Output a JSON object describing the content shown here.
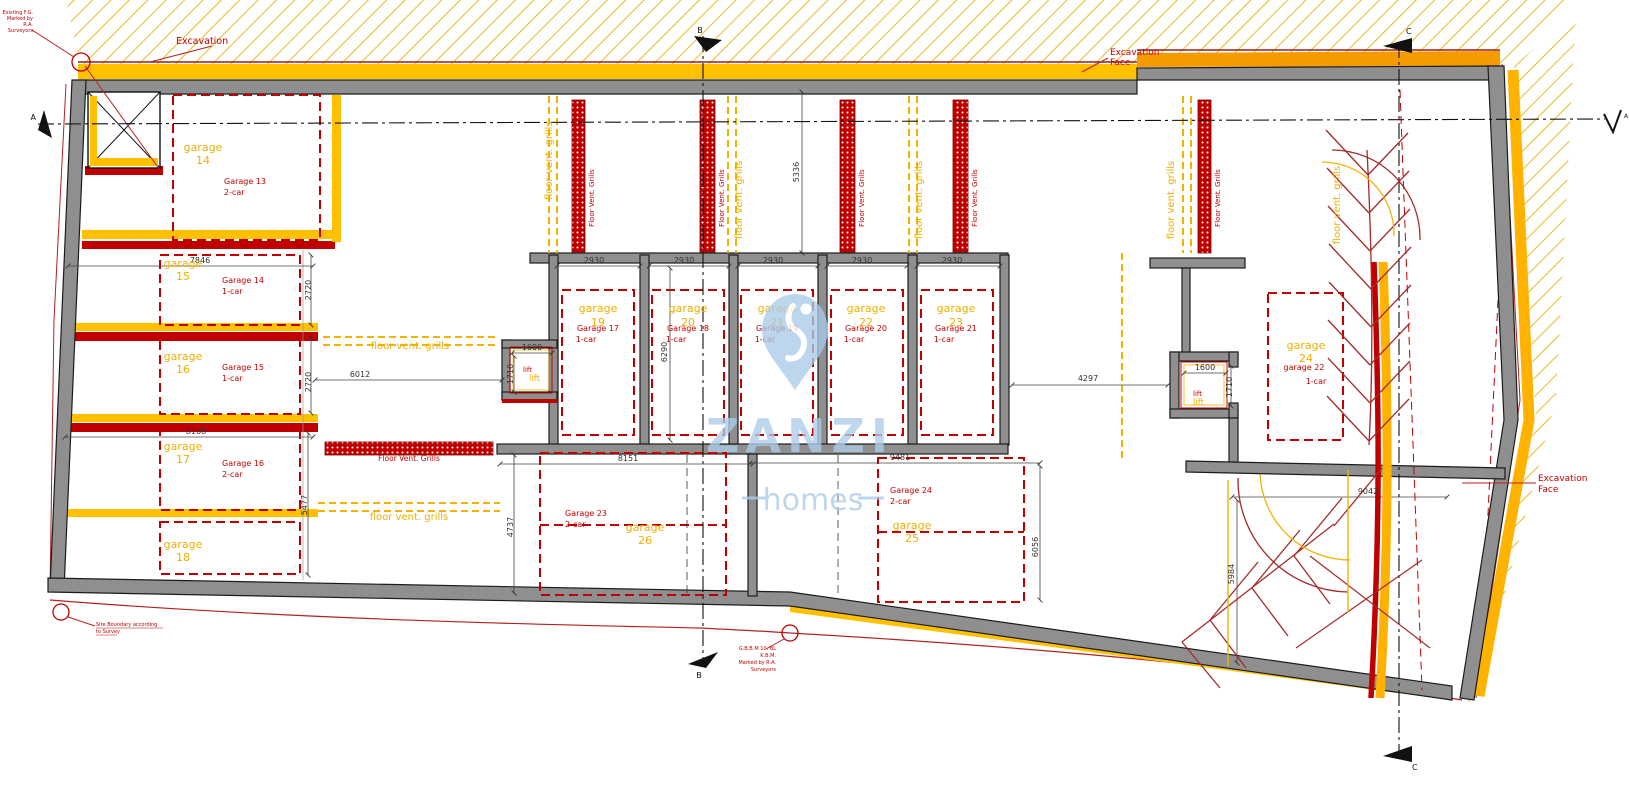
{
  "watermark": {
    "brand": "ZANZI",
    "tagline": "homes"
  },
  "annotations": {
    "excavation": "Excavation",
    "excavation_face": [
      "Excavation",
      "Face"
    ],
    "existing_fg": [
      "Existing F.G.",
      "Marked by",
      "R.A.",
      "Surveyors"
    ],
    "site_boundary": [
      "Site Boundary according",
      "to Survey"
    ],
    "benchmark": [
      "G.B.B.M 10. BL",
      "K.B.M.",
      "Marked by R.A.",
      "Surveyors"
    ]
  },
  "sections": {
    "a": "A",
    "b": "B",
    "c": "C"
  },
  "vents": {
    "red_label": "Floor Vent. Grills",
    "yellow_label": "floor vent. grills"
  },
  "lifts": {
    "left": {
      "red": "lift",
      "yellow": "lift",
      "width": "1600",
      "depth": "1710"
    },
    "right": {
      "red": "lift",
      "yellow": "lift",
      "width": "1600",
      "depth": "1710"
    }
  },
  "garages_left": [
    {
      "label": "garage",
      "num": "14",
      "name": "Garage 13",
      "size": "2-car"
    },
    {
      "label": "garage",
      "num": "15",
      "name": "Garage 14",
      "size": "1-car"
    },
    {
      "label": "garage",
      "num": "16",
      "name": "Garage 15",
      "size": "1-car"
    },
    {
      "label": "garage",
      "num": "17",
      "name": "Garage 16",
      "size": "2-car"
    },
    {
      "label": "garage",
      "num": "18",
      "name": "",
      "size": ""
    }
  ],
  "garages_center": [
    {
      "label": "garage",
      "num": "19",
      "name": "Garage 17",
      "size": "1-car",
      "width": "2930"
    },
    {
      "label": "garage",
      "num": "20",
      "name": "Garage 18",
      "size": "1-car",
      "width": "2930"
    },
    {
      "label": "garage",
      "num": "21",
      "name": "Garage 19",
      "size": "1-car",
      "width": "2930"
    },
    {
      "label": "garage",
      "num": "22",
      "name": "Garage 20",
      "size": "1-car",
      "width": "2930"
    },
    {
      "label": "garage",
      "num": "23",
      "name": "Garage 21",
      "size": "1-car",
      "width": "2930"
    }
  ],
  "garages_bottom": [
    {
      "label": "garage",
      "num": "26",
      "name": "Garage 23",
      "size": "2-car"
    },
    {
      "label": "garage",
      "num": "25",
      "name": "Garage 24",
      "size": "2-car"
    }
  ],
  "garage_right": {
    "label": "garage",
    "num": "24",
    "name": "garage 22",
    "size": "1-car"
  },
  "dims": {
    "d7846": "7846",
    "d2720a": "2720",
    "d2720b": "2720",
    "d8168": "8168",
    "d5477": "5477",
    "d6012": "6012",
    "d5336": "5336",
    "d6290": "6290",
    "d8151": "8151",
    "d4737": "4737",
    "d9481": "9481",
    "d6056": "6056",
    "d4297": "4297",
    "d9042": "9042",
    "d5984": "5984"
  },
  "colors": {
    "wall": "#8f8f8f",
    "accent_yellow": "#ffc000",
    "accent_orange": "#f59b00",
    "accent_red": "#c00000",
    "hatch": "#e5b40c",
    "watermark": "#aecde9",
    "dim_text": "#333333"
  }
}
